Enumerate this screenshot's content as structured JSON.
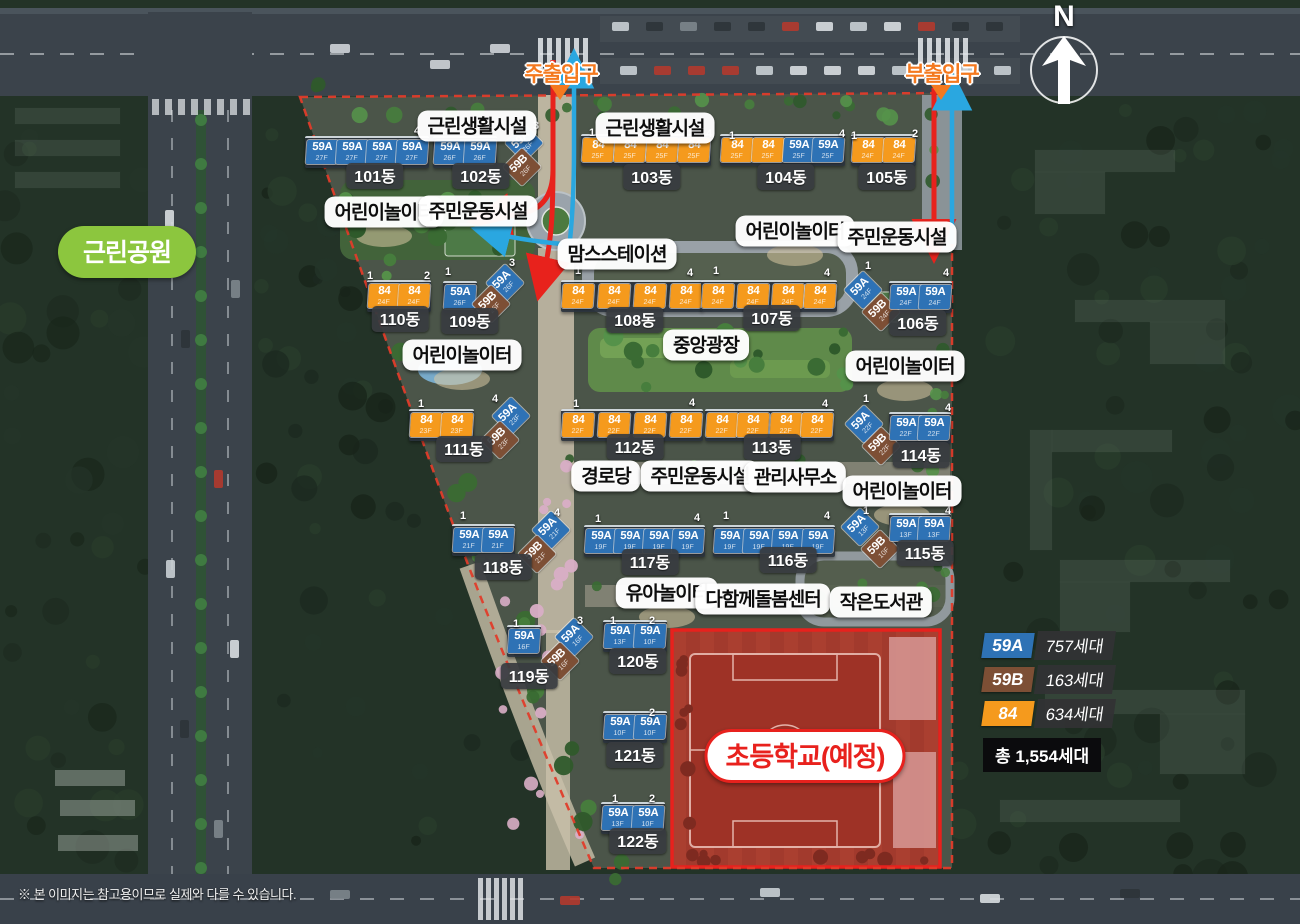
{
  "compass": {
    "label": "N"
  },
  "park_label": {
    "text": "근린공원"
  },
  "entrances": [
    {
      "text": "주출입구",
      "x": 561,
      "y": 73
    },
    {
      "text": "부출입구",
      "x": 942,
      "y": 73
    }
  ],
  "school": {
    "text": "초등학교(예정)"
  },
  "facilities": [
    {
      "text": "근린생활시설",
      "x": 477,
      "y": 126
    },
    {
      "text": "근린생활시설",
      "x": 655,
      "y": 128
    },
    {
      "text": "어린이놀이터",
      "x": 384,
      "y": 212
    },
    {
      "text": "주민운동시설",
      "x": 478,
      "y": 211
    },
    {
      "text": "맘스스테이션",
      "x": 617,
      "y": 254
    },
    {
      "text": "어린이놀이터",
      "x": 795,
      "y": 231
    },
    {
      "text": "주민운동시설",
      "x": 897,
      "y": 237
    },
    {
      "text": "어린이놀이터",
      "x": 462,
      "y": 355
    },
    {
      "text": "중앙광장",
      "x": 706,
      "y": 345
    },
    {
      "text": "어린이놀이터",
      "x": 905,
      "y": 366
    },
    {
      "text": "경로당",
      "x": 606,
      "y": 476
    },
    {
      "text": "주민운동시설",
      "x": 700,
      "y": 476
    },
    {
      "text": "관리사무소",
      "x": 795,
      "y": 477
    },
    {
      "text": "어린이놀이터",
      "x": 902,
      "y": 491
    },
    {
      "text": "유아놀이터",
      "x": 667,
      "y": 593
    },
    {
      "text": "다함께돌봄센터",
      "x": 763,
      "y": 599
    },
    {
      "text": "작은도서관",
      "x": 881,
      "y": 602
    }
  ],
  "unit_types": {
    "59A": {
      "color": "#2e72b5"
    },
    "59B": {
      "color": "#7d4f35"
    },
    "84": {
      "color": "#f59a1d"
    }
  },
  "buildings": [
    {
      "name": "101동",
      "tag": {
        "x": 375,
        "y": 176
      },
      "badges": [
        {
          "t": "59A",
          "f": "27F",
          "x": 322,
          "y": 152
        },
        {
          "t": "59A",
          "f": "27F",
          "x": 352,
          "y": 152
        },
        {
          "t": "59A",
          "f": "27F",
          "x": 382,
          "y": 152
        },
        {
          "t": "59A",
          "f": "27F",
          "x": 412,
          "y": 152
        }
      ],
      "nums": [
        {
          "v": "4",
          "x": 417,
          "y": 131
        }
      ]
    },
    {
      "name": "102동",
      "tag": {
        "x": 481,
        "y": 176
      },
      "badges": [
        {
          "t": "59A",
          "f": "26F",
          "x": 450,
          "y": 152
        },
        {
          "t": "59A",
          "f": "26F",
          "x": 480,
          "y": 152
        },
        {
          "t": "59A",
          "f": "26F",
          "x": 524,
          "y": 143,
          "d": 1
        },
        {
          "t": "59B",
          "f": "26F",
          "x": 522,
          "y": 167,
          "d": 1
        }
      ],
      "nums": [
        {
          "v": "3",
          "x": 536,
          "y": 126
        }
      ]
    },
    {
      "name": "103동",
      "tag": {
        "x": 652,
        "y": 177
      },
      "badges": [
        {
          "t": "84",
          "f": "25F",
          "x": 598,
          "y": 150
        },
        {
          "t": "84",
          "f": "25F",
          "x": 630,
          "y": 150
        },
        {
          "t": "84",
          "f": "25F",
          "x": 662,
          "y": 150
        },
        {
          "t": "84",
          "f": "25F",
          "x": 694,
          "y": 150
        }
      ],
      "nums": [
        {
          "v": "1",
          "x": 592,
          "y": 133
        },
        {
          "v": "4",
          "x": 709,
          "y": 134
        }
      ]
    },
    {
      "name": "104동",
      "tag": {
        "x": 786,
        "y": 177
      },
      "badges": [
        {
          "t": "84",
          "f": "25F",
          "x": 737,
          "y": 150
        },
        {
          "t": "84",
          "f": "25F",
          "x": 768,
          "y": 150
        },
        {
          "t": "59A",
          "f": "25F",
          "x": 799,
          "y": 150
        },
        {
          "t": "59A",
          "f": "25F",
          "x": 828,
          "y": 150
        }
      ],
      "nums": [
        {
          "v": "1",
          "x": 732,
          "y": 136
        },
        {
          "v": "4",
          "x": 842,
          "y": 134
        }
      ]
    },
    {
      "name": "105동",
      "tag": {
        "x": 887,
        "y": 177
      },
      "badges": [
        {
          "t": "84",
          "f": "24F",
          "x": 868,
          "y": 150
        },
        {
          "t": "84",
          "f": "24F",
          "x": 899,
          "y": 150
        }
      ],
      "nums": [
        {
          "v": "1",
          "x": 854,
          "y": 136
        },
        {
          "v": "2",
          "x": 915,
          "y": 134
        }
      ]
    },
    {
      "name": "110동",
      "tag": {
        "x": 400,
        "y": 319
      },
      "badges": [
        {
          "t": "84",
          "f": "24F",
          "x": 384,
          "y": 296
        },
        {
          "t": "84",
          "f": "24F",
          "x": 414,
          "y": 296
        }
      ],
      "nums": [
        {
          "v": "1",
          "x": 370,
          "y": 276
        },
        {
          "v": "2",
          "x": 427,
          "y": 276
        }
      ]
    },
    {
      "name": "109동",
      "tag": {
        "x": 470,
        "y": 321
      },
      "badges": [
        {
          "t": "59A",
          "f": "26F",
          "x": 460,
          "y": 297
        },
        {
          "t": "59A",
          "f": "26F",
          "x": 505,
          "y": 283,
          "d": 1
        },
        {
          "t": "59B",
          "f": "26F",
          "x": 491,
          "y": 304,
          "d": 1
        }
      ],
      "nums": [
        {
          "v": "1",
          "x": 448,
          "y": 272
        },
        {
          "v": "3",
          "x": 512,
          "y": 263
        }
      ]
    },
    {
      "name": "108동",
      "tag": {
        "x": 635,
        "y": 320
      },
      "badges": [
        {
          "t": "84",
          "f": "24F",
          "x": 578,
          "y": 296
        },
        {
          "t": "84",
          "f": "24F",
          "x": 614,
          "y": 296
        },
        {
          "t": "84",
          "f": "24F",
          "x": 650,
          "y": 296
        },
        {
          "t": "84",
          "f": "24F",
          "x": 686,
          "y": 296
        }
      ],
      "nums": [
        {
          "v": "1",
          "x": 578,
          "y": 271
        },
        {
          "v": "4",
          "x": 690,
          "y": 273
        }
      ]
    },
    {
      "name": "107동",
      "tag": {
        "x": 772,
        "y": 318
      },
      "badges": [
        {
          "t": "84",
          "f": "24F",
          "x": 718,
          "y": 296
        },
        {
          "t": "84",
          "f": "24F",
          "x": 753,
          "y": 296
        },
        {
          "t": "84",
          "f": "24F",
          "x": 788,
          "y": 296
        },
        {
          "t": "84",
          "f": "24F",
          "x": 820,
          "y": 296
        }
      ],
      "nums": [
        {
          "v": "1",
          "x": 716,
          "y": 271
        },
        {
          "v": "4",
          "x": 827,
          "y": 273
        }
      ]
    },
    {
      "name": "106동",
      "tag": {
        "x": 918,
        "y": 323
      },
      "badges": [
        {
          "t": "59A",
          "f": "24F",
          "x": 863,
          "y": 290,
          "d": 1
        },
        {
          "t": "59B",
          "f": "24F",
          "x": 881,
          "y": 312,
          "d": 1
        },
        {
          "t": "59A",
          "f": "24F",
          "x": 906,
          "y": 297
        },
        {
          "t": "59A",
          "f": "24F",
          "x": 935,
          "y": 297
        }
      ],
      "nums": [
        {
          "v": "1",
          "x": 868,
          "y": 266
        },
        {
          "v": "4",
          "x": 946,
          "y": 273
        }
      ]
    },
    {
      "name": "111동",
      "tag": {
        "x": 464,
        "y": 449
      },
      "badges": [
        {
          "t": "84",
          "f": "23F",
          "x": 426,
          "y": 425
        },
        {
          "t": "84",
          "f": "23F",
          "x": 457,
          "y": 425
        },
        {
          "t": "59A",
          "f": "23F",
          "x": 511,
          "y": 416,
          "d": 1
        },
        {
          "t": "59B",
          "f": "23F",
          "x": 500,
          "y": 440,
          "d": 1
        }
      ],
      "nums": [
        {
          "v": "1",
          "x": 421,
          "y": 404
        },
        {
          "v": "4",
          "x": 495,
          "y": 399
        }
      ]
    },
    {
      "name": "112동",
      "tag": {
        "x": 635,
        "y": 447
      },
      "badges": [
        {
          "t": "84",
          "f": "22F",
          "x": 578,
          "y": 425
        },
        {
          "t": "84",
          "f": "22F",
          "x": 614,
          "y": 425
        },
        {
          "t": "84",
          "f": "22F",
          "x": 650,
          "y": 425
        },
        {
          "t": "84",
          "f": "22F",
          "x": 686,
          "y": 425
        }
      ],
      "nums": [
        {
          "v": "1",
          "x": 576,
          "y": 404
        },
        {
          "v": "4",
          "x": 692,
          "y": 403
        }
      ]
    },
    {
      "name": "113동",
      "tag": {
        "x": 772,
        "y": 447
      },
      "badges": [
        {
          "t": "84",
          "f": "22F",
          "x": 722,
          "y": 425
        },
        {
          "t": "84",
          "f": "22F",
          "x": 753,
          "y": 425
        },
        {
          "t": "84",
          "f": "22F",
          "x": 786,
          "y": 425
        },
        {
          "t": "84",
          "f": "22F",
          "x": 817,
          "y": 425
        }
      ],
      "nums": [
        {
          "v": "4",
          "x": 825,
          "y": 404
        }
      ]
    },
    {
      "name": "114동",
      "tag": {
        "x": 921,
        "y": 455
      },
      "badges": [
        {
          "t": "59A",
          "f": "22F",
          "x": 864,
          "y": 424,
          "d": 1
        },
        {
          "t": "59B",
          "f": "22F",
          "x": 881,
          "y": 446,
          "d": 1
        },
        {
          "t": "59A",
          "f": "22F",
          "x": 906,
          "y": 428
        },
        {
          "t": "59A",
          "f": "22F",
          "x": 934,
          "y": 428
        }
      ],
      "nums": [
        {
          "v": "1",
          "x": 866,
          "y": 399
        },
        {
          "v": "4",
          "x": 948,
          "y": 408
        }
      ]
    },
    {
      "name": "118동",
      "tag": {
        "x": 503,
        "y": 567
      },
      "badges": [
        {
          "t": "59A",
          "f": "21F",
          "x": 469,
          "y": 540
        },
        {
          "t": "59A",
          "f": "21F",
          "x": 498,
          "y": 540
        },
        {
          "t": "59A",
          "f": "21F",
          "x": 551,
          "y": 530,
          "d": 1
        },
        {
          "t": "59B",
          "f": "21F",
          "x": 537,
          "y": 554,
          "d": 1
        }
      ],
      "nums": [
        {
          "v": "1",
          "x": 463,
          "y": 516
        },
        {
          "v": "4",
          "x": 557,
          "y": 513
        }
      ]
    },
    {
      "name": "117동",
      "tag": {
        "x": 650,
        "y": 562
      },
      "badges": [
        {
          "t": "59A",
          "f": "19F",
          "x": 601,
          "y": 541
        },
        {
          "t": "59A",
          "f": "19F",
          "x": 630,
          "y": 541
        },
        {
          "t": "59A",
          "f": "19F",
          "x": 659,
          "y": 541
        },
        {
          "t": "59A",
          "f": "19F",
          "x": 688,
          "y": 541
        }
      ],
      "nums": [
        {
          "v": "1",
          "x": 598,
          "y": 519
        },
        {
          "v": "4",
          "x": 697,
          "y": 518
        }
      ]
    },
    {
      "name": "116동",
      "tag": {
        "x": 788,
        "y": 560
      },
      "badges": [
        {
          "t": "59A",
          "f": "19F",
          "x": 730,
          "y": 541
        },
        {
          "t": "59A",
          "f": "19F",
          "x": 759,
          "y": 541
        },
        {
          "t": "59A",
          "f": "19F",
          "x": 788,
          "y": 541
        },
        {
          "t": "59A",
          "f": "19F",
          "x": 818,
          "y": 541
        }
      ],
      "nums": [
        {
          "v": "1",
          "x": 726,
          "y": 516
        },
        {
          "v": "4",
          "x": 827,
          "y": 516
        }
      ]
    },
    {
      "name": "115동",
      "tag": {
        "x": 925,
        "y": 553
      },
      "badges": [
        {
          "t": "59A",
          "f": "13F",
          "x": 860,
          "y": 527,
          "d": 1
        },
        {
          "t": "59B",
          "f": "10F",
          "x": 880,
          "y": 549,
          "d": 1
        },
        {
          "t": "59A",
          "f": "13F",
          "x": 906,
          "y": 529
        },
        {
          "t": "59A",
          "f": "13F",
          "x": 934,
          "y": 529
        }
      ],
      "nums": [
        {
          "v": "1",
          "x": 866,
          "y": 511
        },
        {
          "v": "4",
          "x": 948,
          "y": 511
        }
      ]
    },
    {
      "name": "119동",
      "tag": {
        "x": 529,
        "y": 676
      },
      "badges": [
        {
          "t": "59A",
          "f": "16F",
          "x": 524,
          "y": 641
        },
        {
          "t": "59A",
          "f": "16F",
          "x": 574,
          "y": 637,
          "d": 1
        },
        {
          "t": "59B",
          "f": "16F",
          "x": 560,
          "y": 661,
          "d": 1
        }
      ],
      "nums": [
        {
          "v": "1",
          "x": 516,
          "y": 624
        },
        {
          "v": "3",
          "x": 580,
          "y": 621
        }
      ]
    },
    {
      "name": "120동",
      "tag": {
        "x": 638,
        "y": 661
      },
      "badges": [
        {
          "t": "59A",
          "f": "13F",
          "x": 620,
          "y": 636
        },
        {
          "t": "59A",
          "f": "10F",
          "x": 650,
          "y": 636
        }
      ],
      "nums": [
        {
          "v": "1",
          "x": 613,
          "y": 621
        },
        {
          "v": "2",
          "x": 652,
          "y": 621
        }
      ]
    },
    {
      "name": "121동",
      "tag": {
        "x": 635,
        "y": 755
      },
      "badges": [
        {
          "t": "59A",
          "f": "10F",
          "x": 620,
          "y": 727
        },
        {
          "t": "59A",
          "f": "10F",
          "x": 650,
          "y": 727
        }
      ],
      "nums": [
        {
          "v": "2",
          "x": 652,
          "y": 713
        }
      ]
    },
    {
      "name": "122동",
      "tag": {
        "x": 638,
        "y": 841
      },
      "badges": [
        {
          "t": "59A",
          "f": "13F",
          "x": 618,
          "y": 818
        },
        {
          "t": "59A",
          "f": "10F",
          "x": 648,
          "y": 818
        }
      ],
      "nums": [
        {
          "v": "1",
          "x": 615,
          "y": 799
        },
        {
          "v": "2",
          "x": 652,
          "y": 799
        }
      ]
    }
  ],
  "legend": {
    "items": [
      {
        "type": "59A",
        "count": "757세대"
      },
      {
        "type": "59B",
        "count": "163세대"
      },
      {
        "type": "84",
        "count": "634세대"
      }
    ],
    "total": "총 1,554세대"
  },
  "disclaimer": "※ 본 이미지는 참고용이므로 실제와 다를 수 있습니다."
}
